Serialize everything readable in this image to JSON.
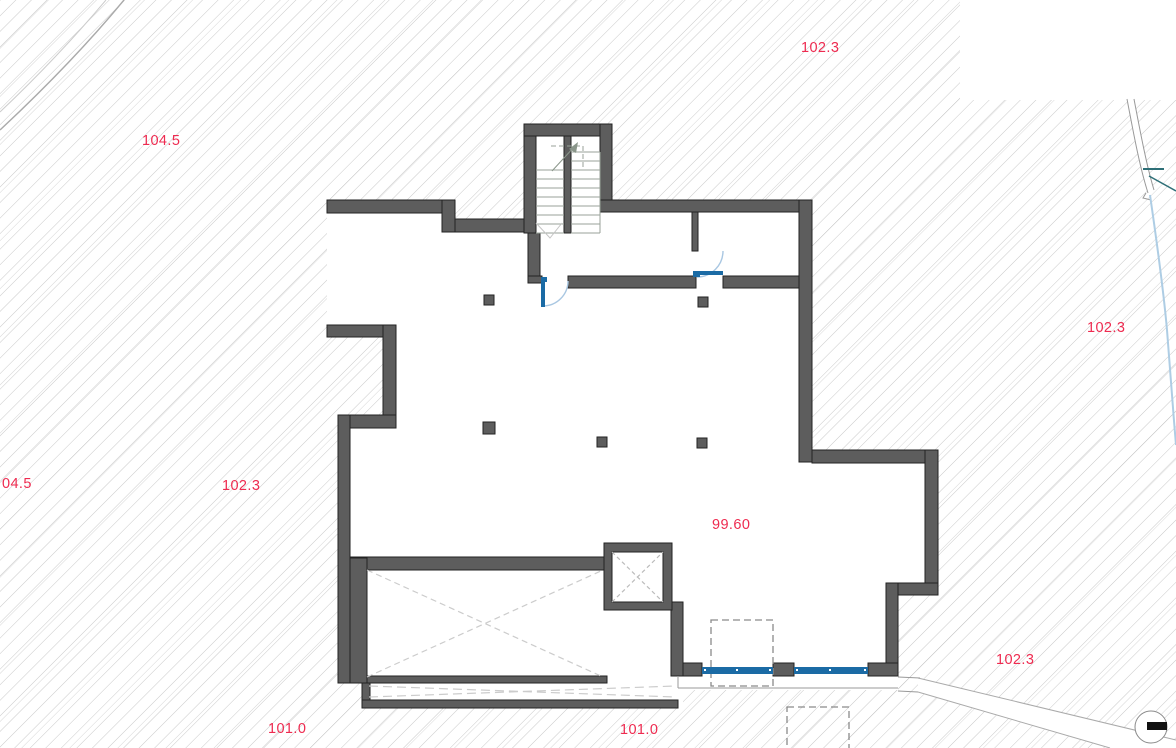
{
  "drawing": {
    "kind": "architectural-floor-plan",
    "level_shown": "basement"
  },
  "labels": [
    {
      "name": "elevation-top",
      "text": "102.3"
    },
    {
      "name": "elevation-upper-left",
      "text": "104.5"
    },
    {
      "name": "elevation-left-clipped",
      "text": "04.5"
    },
    {
      "name": "elevation-mid-left",
      "text": "102.3"
    },
    {
      "name": "elevation-interior",
      "text": "99.60"
    },
    {
      "name": "elevation-right",
      "text": "102.3"
    },
    {
      "name": "elevation-lower-right",
      "text": "102.3"
    },
    {
      "name": "elevation-bottom-left",
      "text": "101.0"
    },
    {
      "name": "elevation-bottom-mid",
      "text": "101.0"
    }
  ],
  "colors": {
    "wall": "#5d5d5d",
    "wall_outline": "#222222",
    "hatch_line": "#c9c9c9",
    "hatch_line_dark": "#b5b5b5",
    "label_red": "#ee2b50",
    "door_leaf_blue": "#1b6ba5",
    "door_arc_blue": "#a9c7e2",
    "window_blue": "#1b6ba5",
    "stream_blue": "#aecde4",
    "survey_teal": "#2e6f77",
    "stair_line": "#98a298",
    "void_dash": "#cccccc"
  }
}
